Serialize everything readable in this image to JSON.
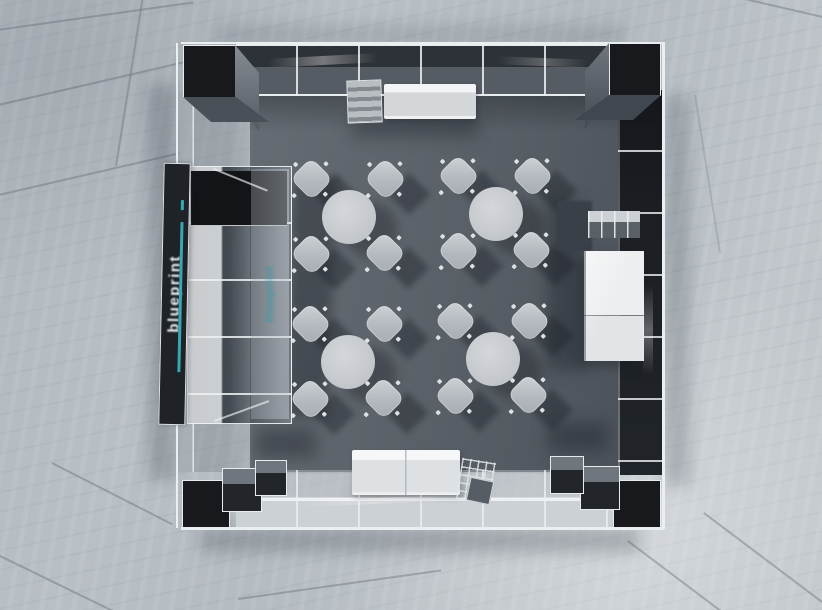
{
  "scene": {
    "viewport_type": "3D overhead camera view",
    "description": "Top-down render of a glass-walled exhibition booth meeting room on a marble floor: four round tables with four chairs each, a branded banner shelf tower on the left, a reception counter and literature rack at top, storage cubes and a white display cabinet on the right, and a white sofa with a magazine stand at the bottom.",
    "branding": {
      "banner_text": "blueprint",
      "accent_color": "#35A8B4",
      "text_color": "#EEF1F3",
      "panel_color": "#1F2328"
    },
    "palette": {
      "marble_floor": "#B6BDC3",
      "interior_floor": "#5A6068",
      "frame_white": "#E9ECEE",
      "structure_dark": "#17191D",
      "table_top": "#C6CACD",
      "chair": "#B8BDC2",
      "sofa": "#EFF1F2",
      "cabinet": "#E7EAEC"
    },
    "furniture": {
      "table_groups": [
        {
          "id": "table-top-left",
          "chairs": 4
        },
        {
          "id": "table-top-right",
          "chairs": 4
        },
        {
          "id": "table-bottom-left",
          "chairs": 4
        },
        {
          "id": "table-bottom-right",
          "chairs": 4
        }
      ],
      "corner_pillars": 4,
      "other_items": [
        "reception counter",
        "literature rack",
        "storage cubes",
        "display cabinet",
        "white sofa",
        "magazine stand",
        "brand banner shelf tower"
      ]
    }
  }
}
